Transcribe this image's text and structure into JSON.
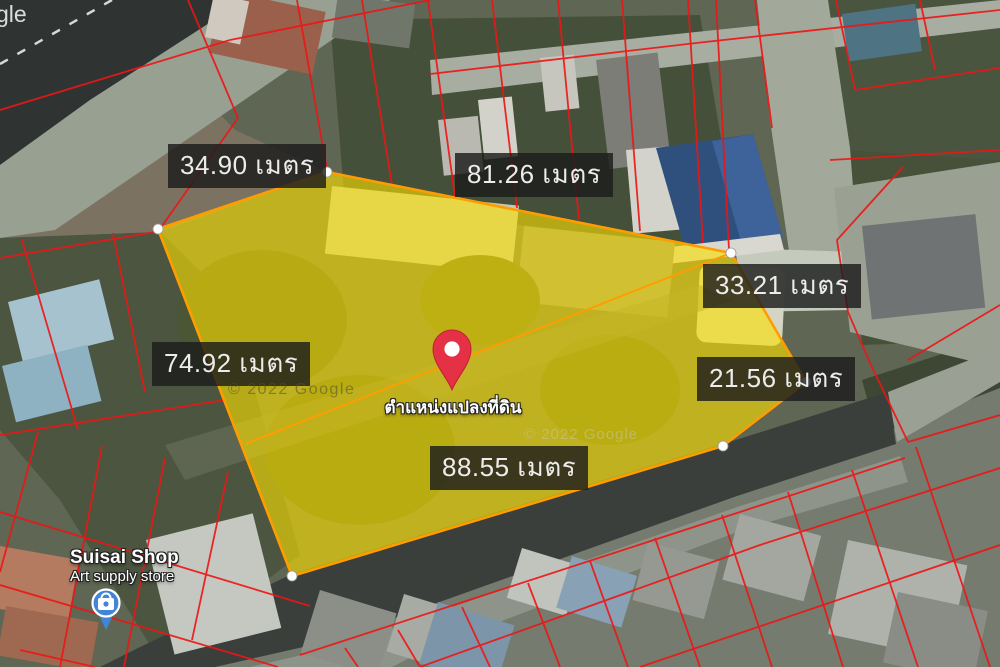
{
  "map": {
    "google_logo_partial": "gle",
    "watermarks": [
      "© 2022 Google",
      "© 2022 Google"
    ],
    "pin": {
      "label": "ตำแหน่งแปลงที่ดิน",
      "x": 452,
      "y": 390
    },
    "poi": {
      "name": "Suisai Shop",
      "type": "Art supply store",
      "x": 106,
      "y": 603
    },
    "parcel": {
      "fill": "#fade00",
      "fill_opacity": 0.62,
      "stroke": "#ff9d00",
      "vertices": [
        [
          158,
          229
        ],
        [
          327,
          172
        ],
        [
          731,
          253
        ],
        [
          806,
          382
        ],
        [
          723,
          446
        ],
        [
          292,
          576
        ]
      ],
      "diagonal": [
        [
          245,
          444
        ],
        [
          731,
          253
        ]
      ]
    },
    "measurements": [
      {
        "side": "northwest",
        "text": "34.90 เมตร"
      },
      {
        "side": "north",
        "text": "81.26 เมตร"
      },
      {
        "side": "northeast",
        "text": "33.21 เมตร"
      },
      {
        "side": "west",
        "text": "74.92 เมตร"
      },
      {
        "side": "east",
        "text": "21.56 เมตร"
      },
      {
        "side": "south",
        "text": "88.55 เมตร"
      }
    ],
    "colors": {
      "cadastral_line": "#ee1515",
      "location_pin": "#e53145",
      "poi_pin": "#4285d7",
      "road_dark": "#3a3f3c"
    }
  }
}
